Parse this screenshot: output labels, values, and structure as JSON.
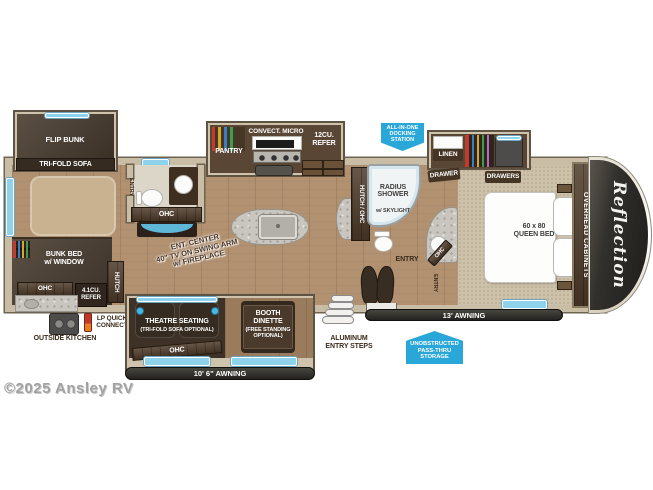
{
  "colors": {
    "badge_blue": "#2aa7d9",
    "window_blue": "#8ed2ec",
    "wall_tan": "#c9bda5",
    "wood_floor": "#b29170",
    "dark_wood": "#4e3b2a",
    "awning_bar": "#2d2c2a"
  },
  "rear": {
    "flip_bunk": "FLIP BUNK",
    "tri_fold_sofa": "TRI-FOLD SOFA",
    "bunk_bed": "BUNK BED\nw/ WINDOW",
    "bunk_ohc": "OHC",
    "refer_41": "4.1CU.\nREFER",
    "hutch": "HUTCH",
    "outside_kitchen": "OUTSIDE KITCHEN",
    "lp_quick_connect": "LP QUICK\nCONNECT"
  },
  "bath_rear": {
    "entry": "ENTRY",
    "ohc": "OHC",
    "ent_center": "ENT. CENTER\n40\" TV ON SWING ARM\nw/ FIREPLACE"
  },
  "kitchen": {
    "pantry": "PANTRY",
    "convect_micro": "CONVECT. MICRO",
    "refer_12": "12CU.\nREFER",
    "hutch_ohc": "HUTCH / OHC"
  },
  "living": {
    "theatre": "THEATRE SEATING",
    "theatre_optional": "(TRI-FOLD SOFA OPTIONAL)",
    "theatre_ohc": "OHC",
    "booth": "BOOTH\nDINETTE",
    "booth_optional": "(FREE STANDING\nOPTIONAL)"
  },
  "bath_front": {
    "shower": "RADIUS\nSHOWER",
    "skylight": "w/ SKYLIGHT",
    "ohc": "OHC",
    "entry_main": "ENTRY",
    "entry_bedroom": "ENTRY"
  },
  "bedroom": {
    "linen": "LINEN",
    "drawer": "DRAWER",
    "drawers": "DRAWERS",
    "bed": "60 x 80\nQUEEN BED",
    "overhead_cabinets": "OVERHEAD CABINETS",
    "brand": "Reflection"
  },
  "exterior": {
    "docking_station": "ALL-IN-ONE\nDOCKING\nSTATION",
    "pass_thru": "UNOBSTRUCTED\nPASS-THRU\nSTORAGE",
    "awning_rear": "10' 6\" AWNING",
    "awning_front": "13' AWNING",
    "entry_steps": "ALUMINUM\nENTRY STEPS"
  },
  "watermark": "©2025 Ansley RV"
}
